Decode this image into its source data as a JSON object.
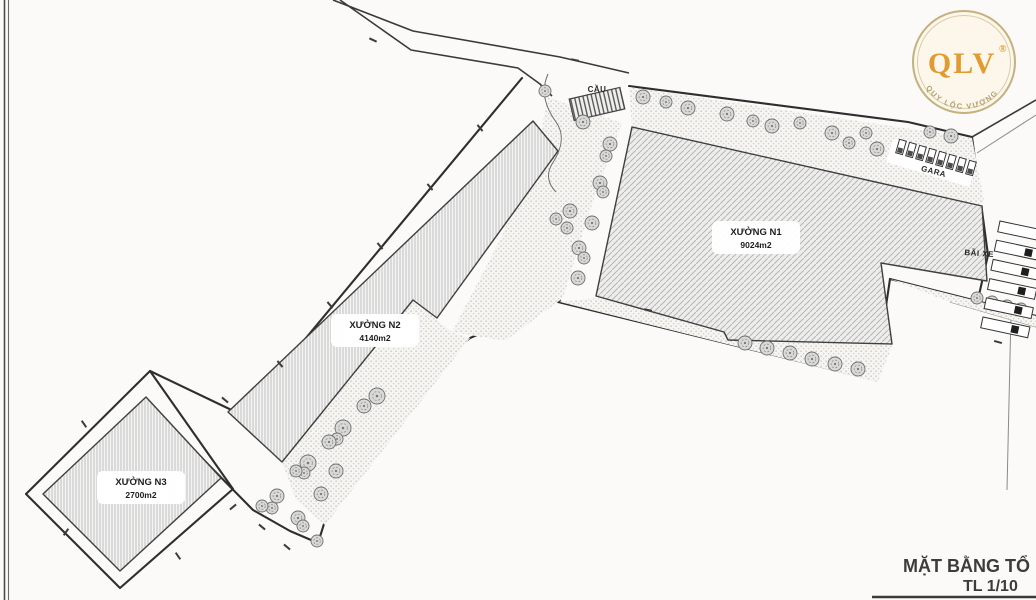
{
  "plan": {
    "labels": {
      "cau": "CẦU",
      "gara": "GARA",
      "bai_xe": "BÃI XE"
    },
    "buildings": {
      "n1": {
        "name": "XƯỞNG N1",
        "area": "9024m2"
      },
      "n2": {
        "name": "XƯỞNG N2",
        "area": "4140m2"
      },
      "n3": {
        "name": "XƯỞNG N3",
        "area": "2700m2"
      }
    }
  },
  "logo": {
    "text": "QLV",
    "registered": "®",
    "subtext": "QUY LỘC VƯỢNG"
  },
  "title_block": {
    "title": "MẶT BẰNG TỔ",
    "scale": "TL 1/10"
  },
  "colors": {
    "logo_gold": "#E09B33",
    "logo_ring": "#C3B27F",
    "line_dark": "#2e2e2e"
  }
}
